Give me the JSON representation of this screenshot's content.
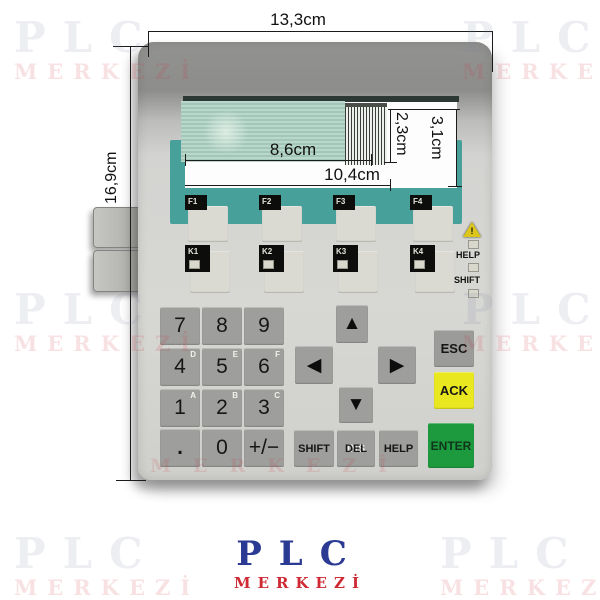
{
  "watermark": {
    "line1": "PLC",
    "line2": "MERKEZİ"
  },
  "logo": {
    "line1": "PLC",
    "line2": "MERKEZİ"
  },
  "dimensions": {
    "overall_width": "13,3cm",
    "overall_height": "16,9cm",
    "display_width": "8,6cm",
    "cutout_width": "10,4cm",
    "display_height": "2,3cm",
    "cutout_height": "3,1cm"
  },
  "panel": {
    "fkeys": [
      {
        "label": "F1"
      },
      {
        "label": "F2"
      },
      {
        "label": "F3"
      },
      {
        "label": "F4"
      }
    ],
    "kkeys": [
      {
        "label": "K1"
      },
      {
        "label": "K2"
      },
      {
        "label": "K3"
      },
      {
        "label": "K4"
      }
    ],
    "indicators": {
      "warning": "!",
      "help": "HELP",
      "shift": "SHIFT"
    },
    "numpad": [
      {
        "label": "7"
      },
      {
        "label": "8"
      },
      {
        "label": "9"
      },
      {
        "label": "4",
        "sub": "D"
      },
      {
        "label": "5",
        "sub": "E"
      },
      {
        "label": "6",
        "sub": "F"
      },
      {
        "label": "1",
        "sub": "A"
      },
      {
        "label": "2",
        "sub": "B"
      },
      {
        "label": "3",
        "sub": "C"
      },
      {
        "label": "."
      },
      {
        "label": "0"
      },
      {
        "label": "+/−"
      }
    ],
    "arrows": {
      "up": "▲",
      "left": "◀",
      "right": "▶",
      "down": "▼"
    },
    "keys": {
      "shift": "SHIFT",
      "ins": "INS",
      "del": "DEL",
      "help": "HELP",
      "esc": "ESC",
      "ack": "ACK",
      "enter": "ENTER"
    }
  },
  "colors": {
    "teal": "#47a19a",
    "ack_yellow": "#e9e71f",
    "enter_green": "#1d9a3d",
    "logo_blue": "#2b3a93",
    "logo_red": "#cf2a33"
  }
}
